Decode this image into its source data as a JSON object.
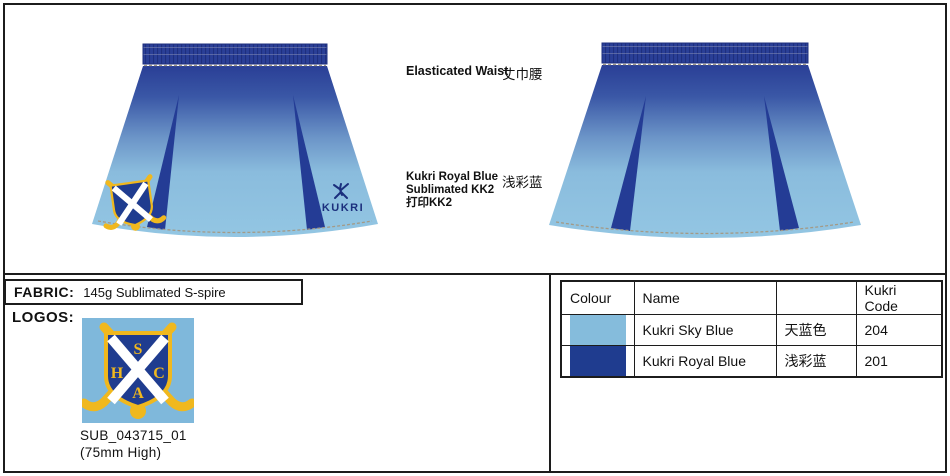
{
  "annotations": {
    "waist_label": "Elasticated Waist",
    "waist_label_cn": "丈巾腰",
    "panel_note_line1": "Kukri Royal Blue",
    "panel_note_line2": "Sublimated KK2",
    "panel_note_line3": "打印KK2",
    "panel_note_cn": "浅彩蓝"
  },
  "fabric": {
    "label": "FABRIC:",
    "value": "145g Sublimated S-spire"
  },
  "logos": {
    "label": "LOGOS:",
    "code": "SUB_043715_01",
    "size_note": "(75mm  High)"
  },
  "garment": {
    "brand": "KUKRI",
    "crest_letters": {
      "top": "S",
      "left": "H",
      "right": "C",
      "bottom": "A"
    }
  },
  "color_table": {
    "headers": [
      "Colour",
      "Name",
      "",
      "Kukri Code"
    ],
    "rows": [
      {
        "swatch": "#85BCDC",
        "name": "Kukri Sky Blue",
        "cn": "天蓝色",
        "code": "204"
      },
      {
        "swatch": "#1F3C8F",
        "name": "Kukri Royal Blue",
        "cn": "浅彩蓝",
        "code": "201"
      }
    ]
  },
  "colors": {
    "sky_blue": "#85BCDC",
    "royal_blue": "#243C95",
    "gradient_top": "#2A3F96",
    "gradient_bottom": "#93C6E3",
    "crest_background": "#7FB8DB",
    "crest_gold": "#F0B81E",
    "brand_navy": "#1B2F7D",
    "stitch_grey": "#A39A87"
  }
}
